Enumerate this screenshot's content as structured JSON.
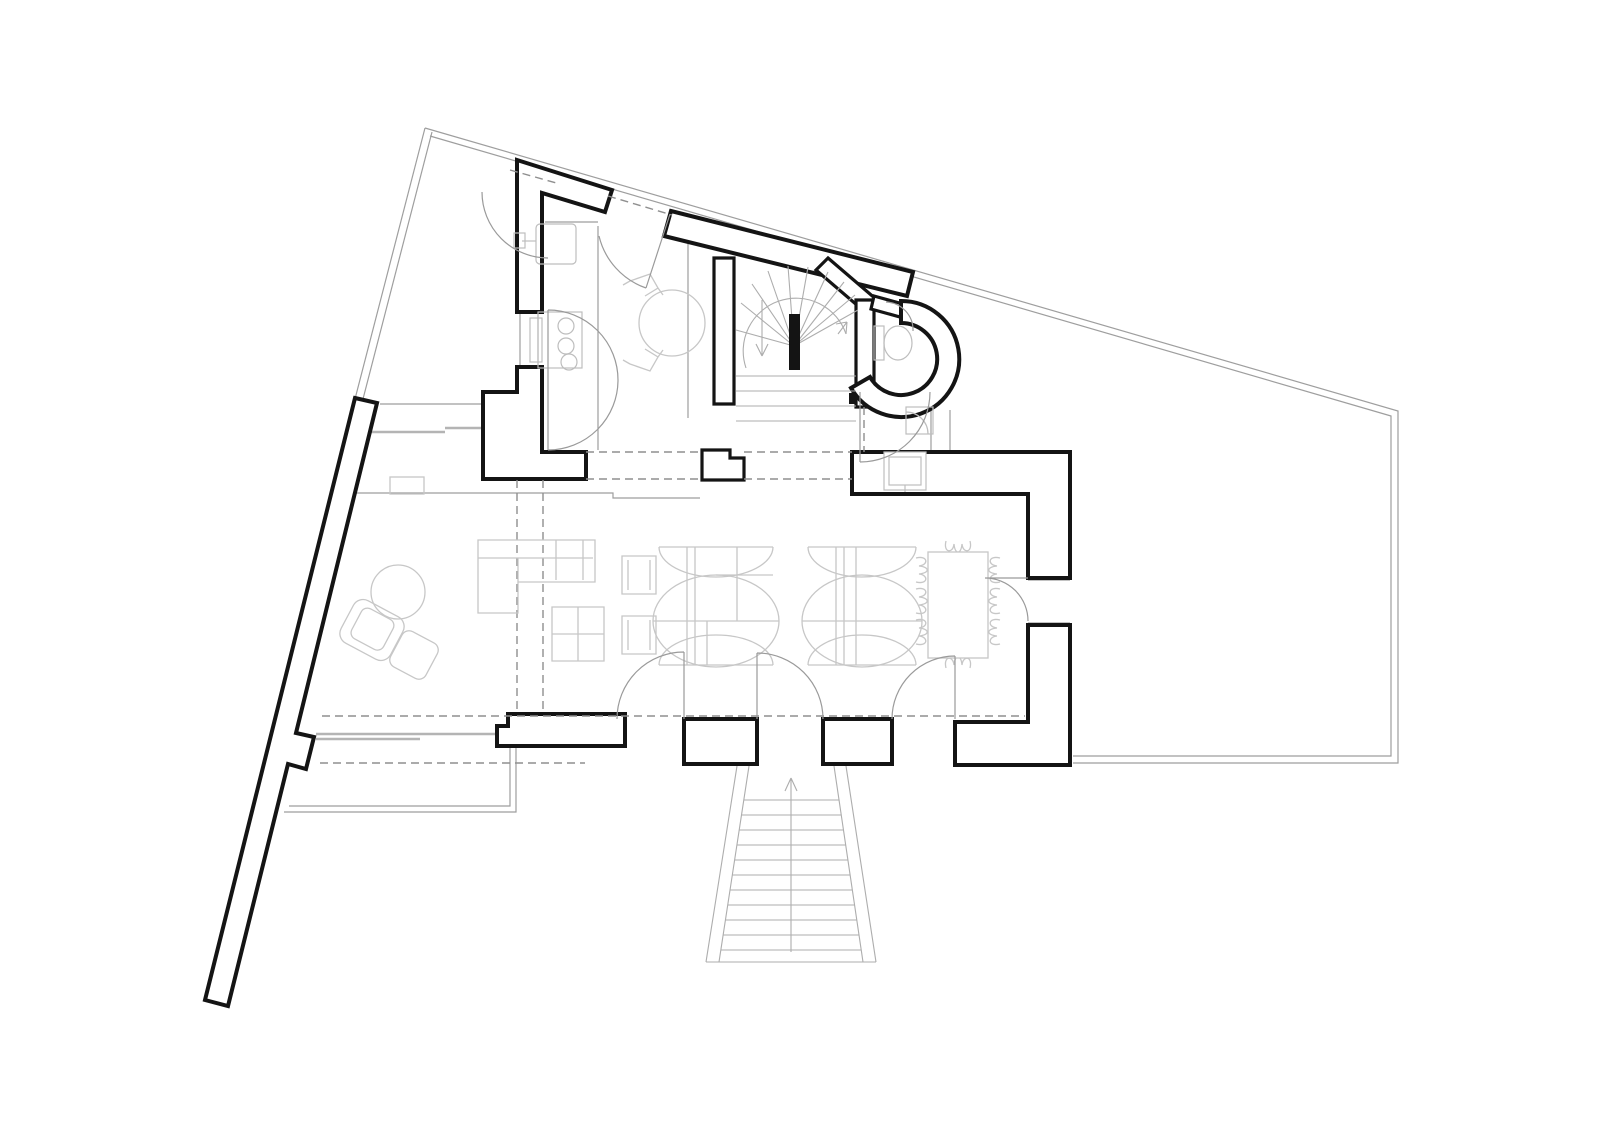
{
  "document": {
    "label": "architectural ground-floor plan, black line drawing on white",
    "visible_text": ""
  },
  "colors": {
    "background": "#ffffff",
    "walls": "#141414",
    "boundary": "#9e9e9e",
    "stairs": "#adadad",
    "furniture": "#c7c7c7",
    "fixtures": "#bdbdbd",
    "doors": "#9a9a9a",
    "dashed": "#8f8f8f"
  },
  "elements": {
    "site": {
      "boundary": "irregular quadrilateral plot, thin double line",
      "boundary_wall": "long thick diagonal wall on west side",
      "terrace": "rectangular terrace at south-west",
      "exterior_stair": {
        "type": "splayed straight stair, south entry",
        "treads": 11,
        "direction_arrow": "up"
      }
    },
    "rooms": [
      {
        "name": "kitchen",
        "fixtures": {
          "sink": 1,
          "stove_burners": 3,
          "oven": 1,
          "round_table": 1,
          "chairs": 2,
          "double-acting-door": 1
        }
      },
      {
        "name": "entry-hall",
        "fixtures": {
          "entrance_door": 1,
          "dashed_overhead_lines": 2
        }
      },
      {
        "name": "stair-hall",
        "fixtures": {
          "winder_stair_fan_treads": 10,
          "straight_treads": 4,
          "newel": 1,
          "up_arrow": 1,
          "down_arrow": 1
        }
      },
      {
        "name": "wc-bathroom",
        "fixtures": {
          "curved_wall": 1,
          "toilet": 1,
          "shower": 1,
          "basin_niche": 1,
          "doors": 2
        }
      },
      {
        "name": "living-room",
        "fixtures": {
          "l_sofa": 1,
          "coffee_table_4sq": 1,
          "armchair": 1,
          "ottoman": 1,
          "side_table": 1,
          "small_armchairs": 2,
          "radiator": 1
        }
      },
      {
        "name": "lounge-area",
        "fixtures": {
          "scalloped_lounge_units": 2
        }
      },
      {
        "name": "dining-area",
        "fixtures": {
          "table": 1,
          "chairs": 8
        }
      }
    ],
    "doors": {
      "south_glass_doors": 3,
      "east_door": 1,
      "kitchen_door": 1,
      "bath_door": 1,
      "gate_arc_nw": 1
    },
    "glazing": {
      "west_window_band": 1,
      "south_west_glazing": 1
    }
  }
}
